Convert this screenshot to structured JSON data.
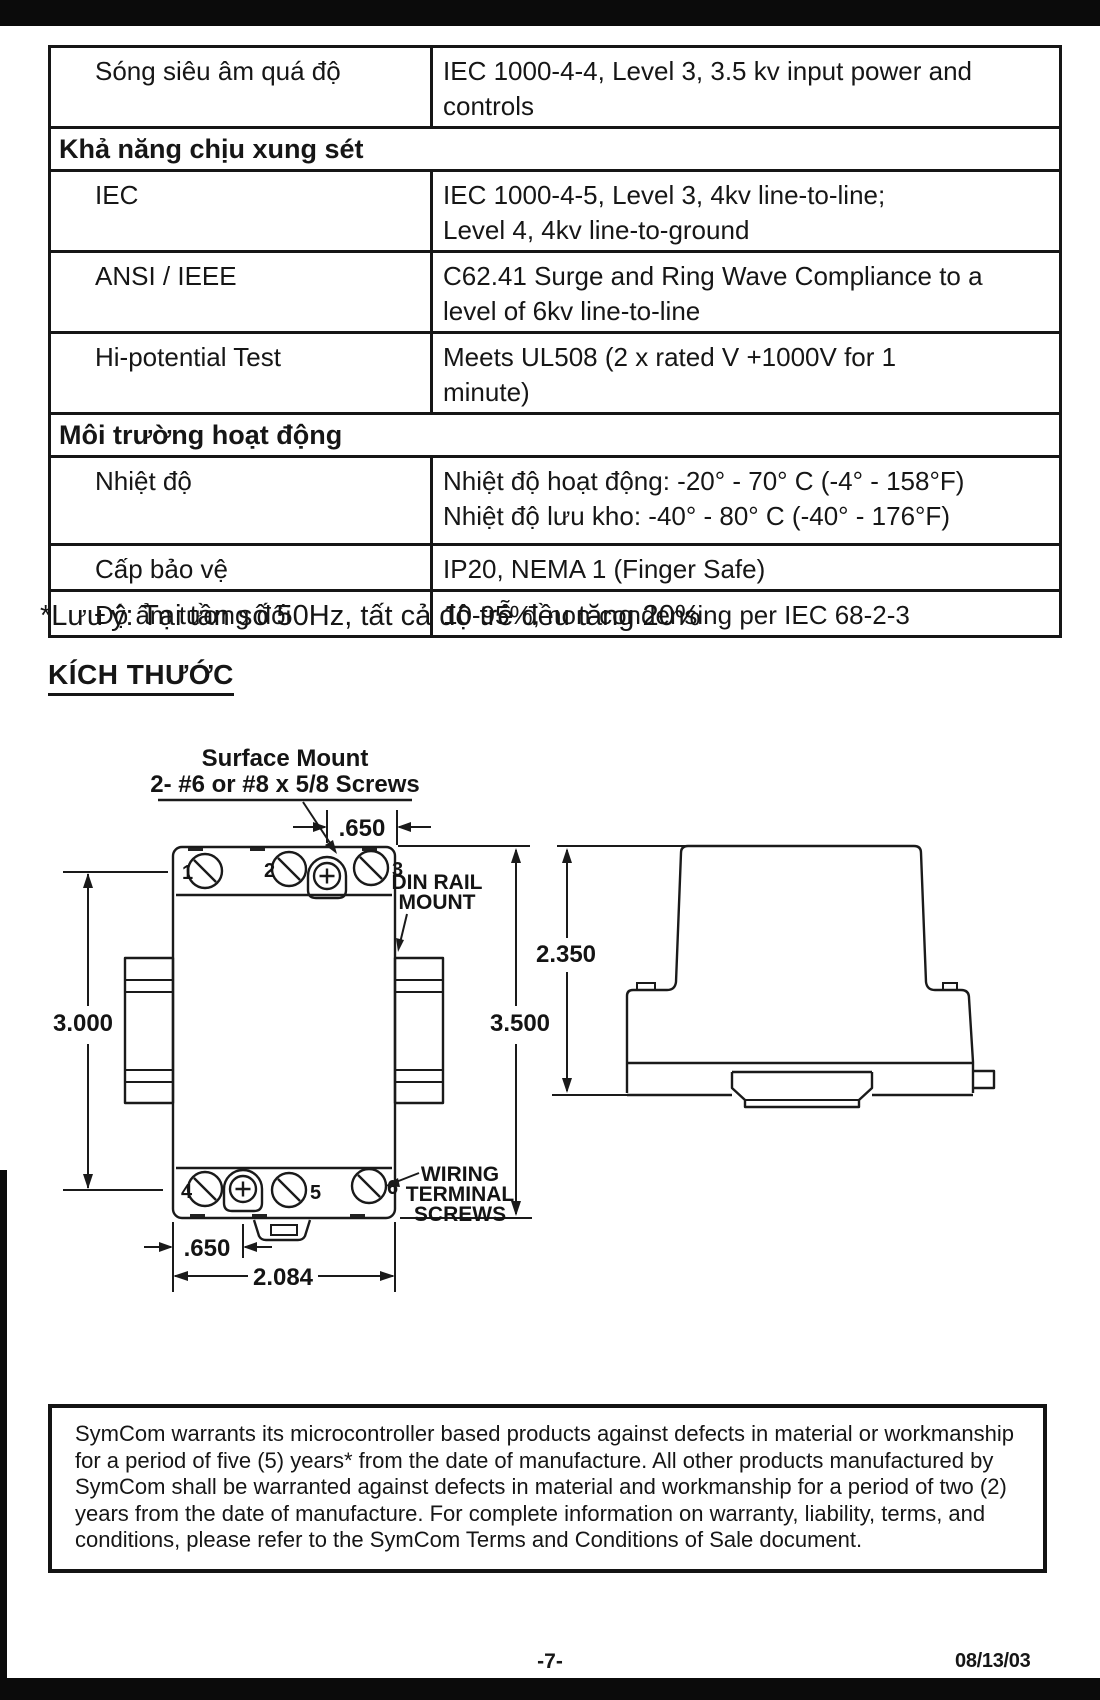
{
  "spec_table": {
    "rows": [
      {
        "type": "data",
        "label": "Sóng siêu âm quá độ",
        "value_lines": [
          "IEC 1000-4-4, Level 3, 3.5 kv input power and",
          "controls"
        ]
      },
      {
        "type": "section",
        "label": "Khả năng chịu xung sét"
      },
      {
        "type": "data",
        "label": "IEC",
        "value_lines": [
          "IEC 1000-4-5, Level 3, 4kv line-to-line;",
          "Level 4, 4kv line-to-ground"
        ]
      },
      {
        "type": "data",
        "label": "ANSI / IEEE",
        "value_lines": [
          "C62.41 Surge and Ring Wave Compliance to a",
          "level of 6kv line-to-line"
        ]
      },
      {
        "type": "data",
        "label": "Hi-potential Test",
        "value_lines": [
          "Meets UL508 (2 x rated V +1000V for 1",
          "minute)"
        ]
      },
      {
        "type": "section",
        "label": "Môi trường hoạt động"
      },
      {
        "type": "data",
        "label": "Nhiệt độ",
        "value_lines": [
          "Nhiệt độ hoạt động: -20° - 70° C (-4° - 158°F)",
          "Nhiệt độ lưu kho: -40° - 80° C (-40° - 176°F)"
        ]
      },
      {
        "type": "data",
        "label": "Cấp bảo vệ",
        "value_lines": [
          "IP20, NEMA 1 (Finger Safe)"
        ]
      },
      {
        "type": "data",
        "label": "Độ ẩm tương đối",
        "value_lines": [
          "10-95%, non-condensing per IEC 68-2-3"
        ]
      }
    ]
  },
  "note": "*Lưu ý: Tại tần số 50Hz, tất cả độ trễ đều tăng 20%",
  "dimensions_heading": "KÍCH THƯỚC",
  "diagram": {
    "surface_mount_line1": "Surface Mount",
    "surface_mount_line2": "2- #6 or #8 x 5/8 Screws",
    "din_rail_line1": "DIN RAIL",
    "din_rail_line2": "MOUNT",
    "wiring_line1": "WIRING",
    "wiring_line2": "TERMINAL",
    "wiring_line3": "SCREWS",
    "dim_650_top": ".650",
    "dim_3000": "3.000",
    "dim_3500": "3.500",
    "dim_2350": "2.350",
    "dim_650_bottom": ".650",
    "dim_2084": "2.084",
    "screw_labels": [
      "1",
      "2",
      "3",
      "4",
      "5",
      "6"
    ]
  },
  "warranty": {
    "lines": [
      "SymCom warrants its microcontroller based products against defects in material or workmanship",
      "for a period of five (5) years* from the date of manufacture. All other products manufactured by",
      "SymCom shall be warranted against defects in material and workmanship for a period of two (2)",
      "years from the date of manufacture. For complete information on warranty, liability, terms, and",
      "conditions, please refer to the SymCom Terms and Conditions of Sale document."
    ]
  },
  "footer": {
    "page_number": "-7-",
    "date": "08/13/03"
  }
}
